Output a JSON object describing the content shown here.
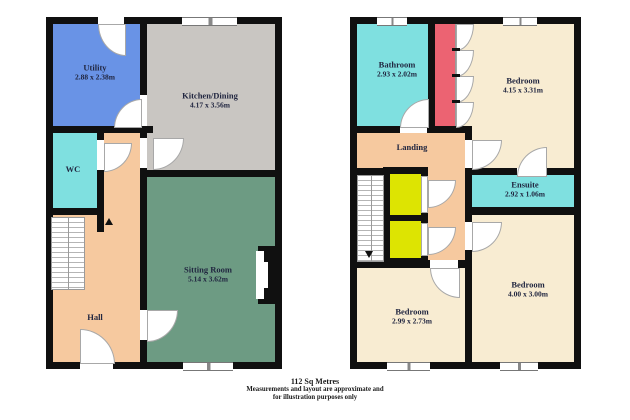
{
  "ground": {
    "utility": {
      "name": "Utility",
      "dims": "2.88 x 2.38m"
    },
    "kitchen": {
      "name": "Kitchen/Dining",
      "dims": "4.17 x 3.56m"
    },
    "wc": {
      "name": "WC"
    },
    "hall": {
      "name": "Hall"
    },
    "sitting": {
      "name": "Sitting Room",
      "dims": "5.14 x 3.62m"
    }
  },
  "first": {
    "bathroom": {
      "name": "Bathroom",
      "dims": "2.93 x 2.02m"
    },
    "bedroom1": {
      "name": "Bedroom",
      "dims": "4.15 x 3.31m"
    },
    "landing": {
      "name": "Landing"
    },
    "ensuite": {
      "name": "Ensuite",
      "dims": "2.92 x 1.06m"
    },
    "bedroom2": {
      "name": "Bedroom",
      "dims": "2.99 x 2.73m"
    },
    "bedroom3": {
      "name": "Bedroom",
      "dims": "4.00 x 3.00m"
    }
  },
  "caption": {
    "area": "112 Sq Metres",
    "disclaimer1": "Measurements and layout are approximate and",
    "disclaimer2": "for illustration purposes only"
  },
  "colors": {
    "utility": "#6993e6",
    "kitchen": "#c9c6c2",
    "cyan": "#7fe0e0",
    "peach": "#f6c99f",
    "green": "#6d9b83",
    "cream": "#f8ecd2",
    "wardrobe_red": "#ec6372",
    "cupboard_yellow": "#dde402",
    "wall": "#101010"
  }
}
